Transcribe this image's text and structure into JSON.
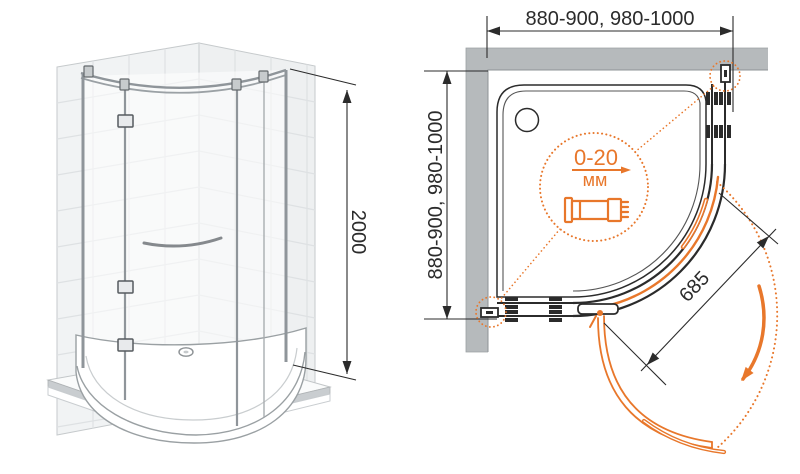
{
  "diagram_type": "shower-enclosure-installation-drawing",
  "side_view": {
    "height_dim": "2000"
  },
  "plan_view": {
    "width_dim": "880-900, 980-1000",
    "depth_dim": "880-900, 980-1000",
    "door_dim": "685",
    "detail_callout": {
      "range": "0-20",
      "unit": "мм"
    }
  },
  "icons": {
    "detail_profile_icon": "telescopic-wall-profile",
    "swing_arrow_icon": "door-swing-direction-arrow"
  },
  "colors": {
    "accent_orange": "#E8772B",
    "line_black": "#2B2B2B",
    "wall_gray": "#B6BABC",
    "tile_fill": "#F1F3F4",
    "tile_grout": "#DEE1E3",
    "chrome_gray": "#8F959A",
    "floor_edge_gray": "#C9CDD0"
  }
}
